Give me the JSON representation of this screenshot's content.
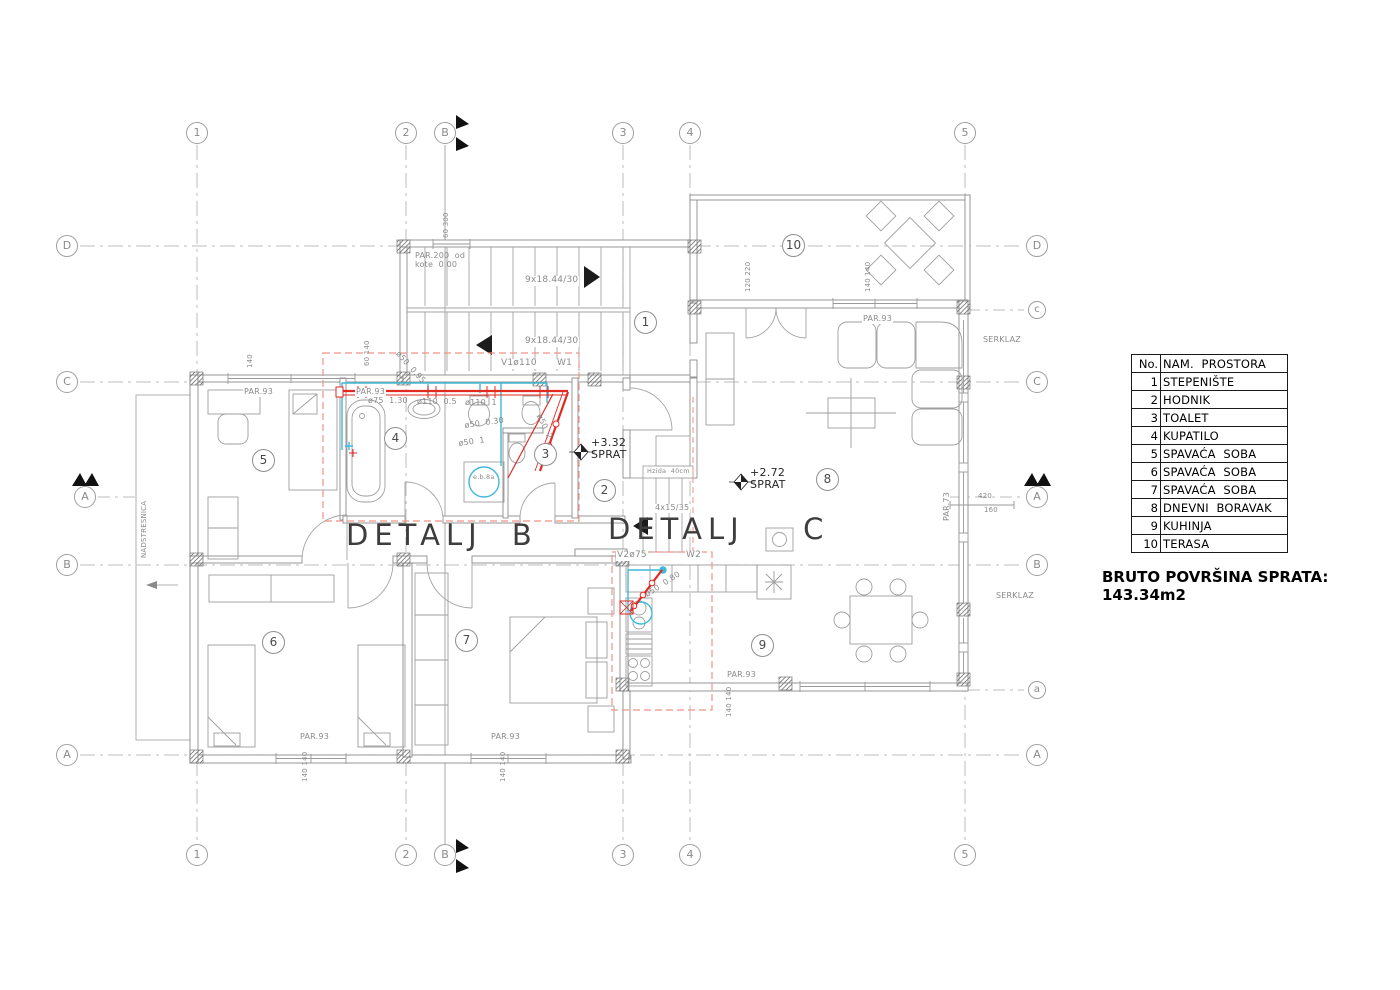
{
  "page": {
    "title_detail_b": "DETALJ B",
    "title_detail_c": "DETALJ  C",
    "area_note": "BRUTO POVRŠINA SPRATA: 143.34m2"
  },
  "legend": {
    "header_no": "No.",
    "header_name": "NAM.  PROSTORA",
    "rows": [
      {
        "no": "1",
        "name": "STEPENIŠTE"
      },
      {
        "no": "2",
        "name": "HODNIK"
      },
      {
        "no": "3",
        "name": "TOALET"
      },
      {
        "no": "4",
        "name": "KUPATILO"
      },
      {
        "no": "5",
        "name": "SPAVAĆA  SOBA"
      },
      {
        "no": "6",
        "name": "SPAVAĆA  SOBA"
      },
      {
        "no": "7",
        "name": "SPAVAĆA  SOBA"
      },
      {
        "no": "8",
        "name": "DNEVNI  BORAVAK"
      },
      {
        "no": "9",
        "name": "KUHINJA"
      },
      {
        "no": "10",
        "name": "TERASA"
      }
    ]
  },
  "axes": {
    "c1": "1",
    "c2": "2",
    "c3": "3",
    "c4": "4",
    "c5": "5",
    "rA": "A",
    "rB": "B",
    "rC": "C",
    "rD": "D",
    "rc_small": "c",
    "ra_small": "a",
    "section_a": "A",
    "section_b": "B"
  },
  "rooms": {
    "r1": "1",
    "r2": "2",
    "r3": "3",
    "r4": "4",
    "r5": "5",
    "r6": "6",
    "r7": "7",
    "r8": "8",
    "r9": "9",
    "r10": "10"
  },
  "labels": {
    "par200_1": "PAR.200  od",
    "par200_2": "kote  0.00",
    "stairs_main": "9x18.44/30",
    "stairs_small": "4x15/35",
    "v1": "V1ø110",
    "w1": "W1",
    "v2": "V2ø75",
    "w2": "W2",
    "elev1": "+3.32",
    "elev2": "+2.72",
    "sprat": "SPRAT",
    "hzida": "Hzida  40cm",
    "serklaz": "SERKLAZ",
    "par73": "PAR.73",
    "par93": "PAR.93",
    "nadstresnica": "NADSTRESNICA",
    "eb8a": "e.b.8a"
  },
  "pipes": {
    "p75": "ø75  1.30",
    "p110a": "ø110  0.5",
    "p110b": "ø110  1",
    "p50_095": "ø50  0.95",
    "p50_030": "ø50  0.30",
    "p50_1": "ø50  1",
    "p50_2": "ø50  2",
    "p50_080": "ø50  0.80"
  },
  "dims": {
    "d140": "140",
    "d140140": "140 140",
    "d60300": "60 300",
    "d60140": "60 140",
    "d120220": "120 220",
    "d420": "420",
    "d160": "160"
  },
  "colors": {
    "pipe_red": "#e02a22",
    "water_cyan": "#3fb9da",
    "detail_box_red": "#f19387",
    "line_gray": "#8c8c8c"
  }
}
